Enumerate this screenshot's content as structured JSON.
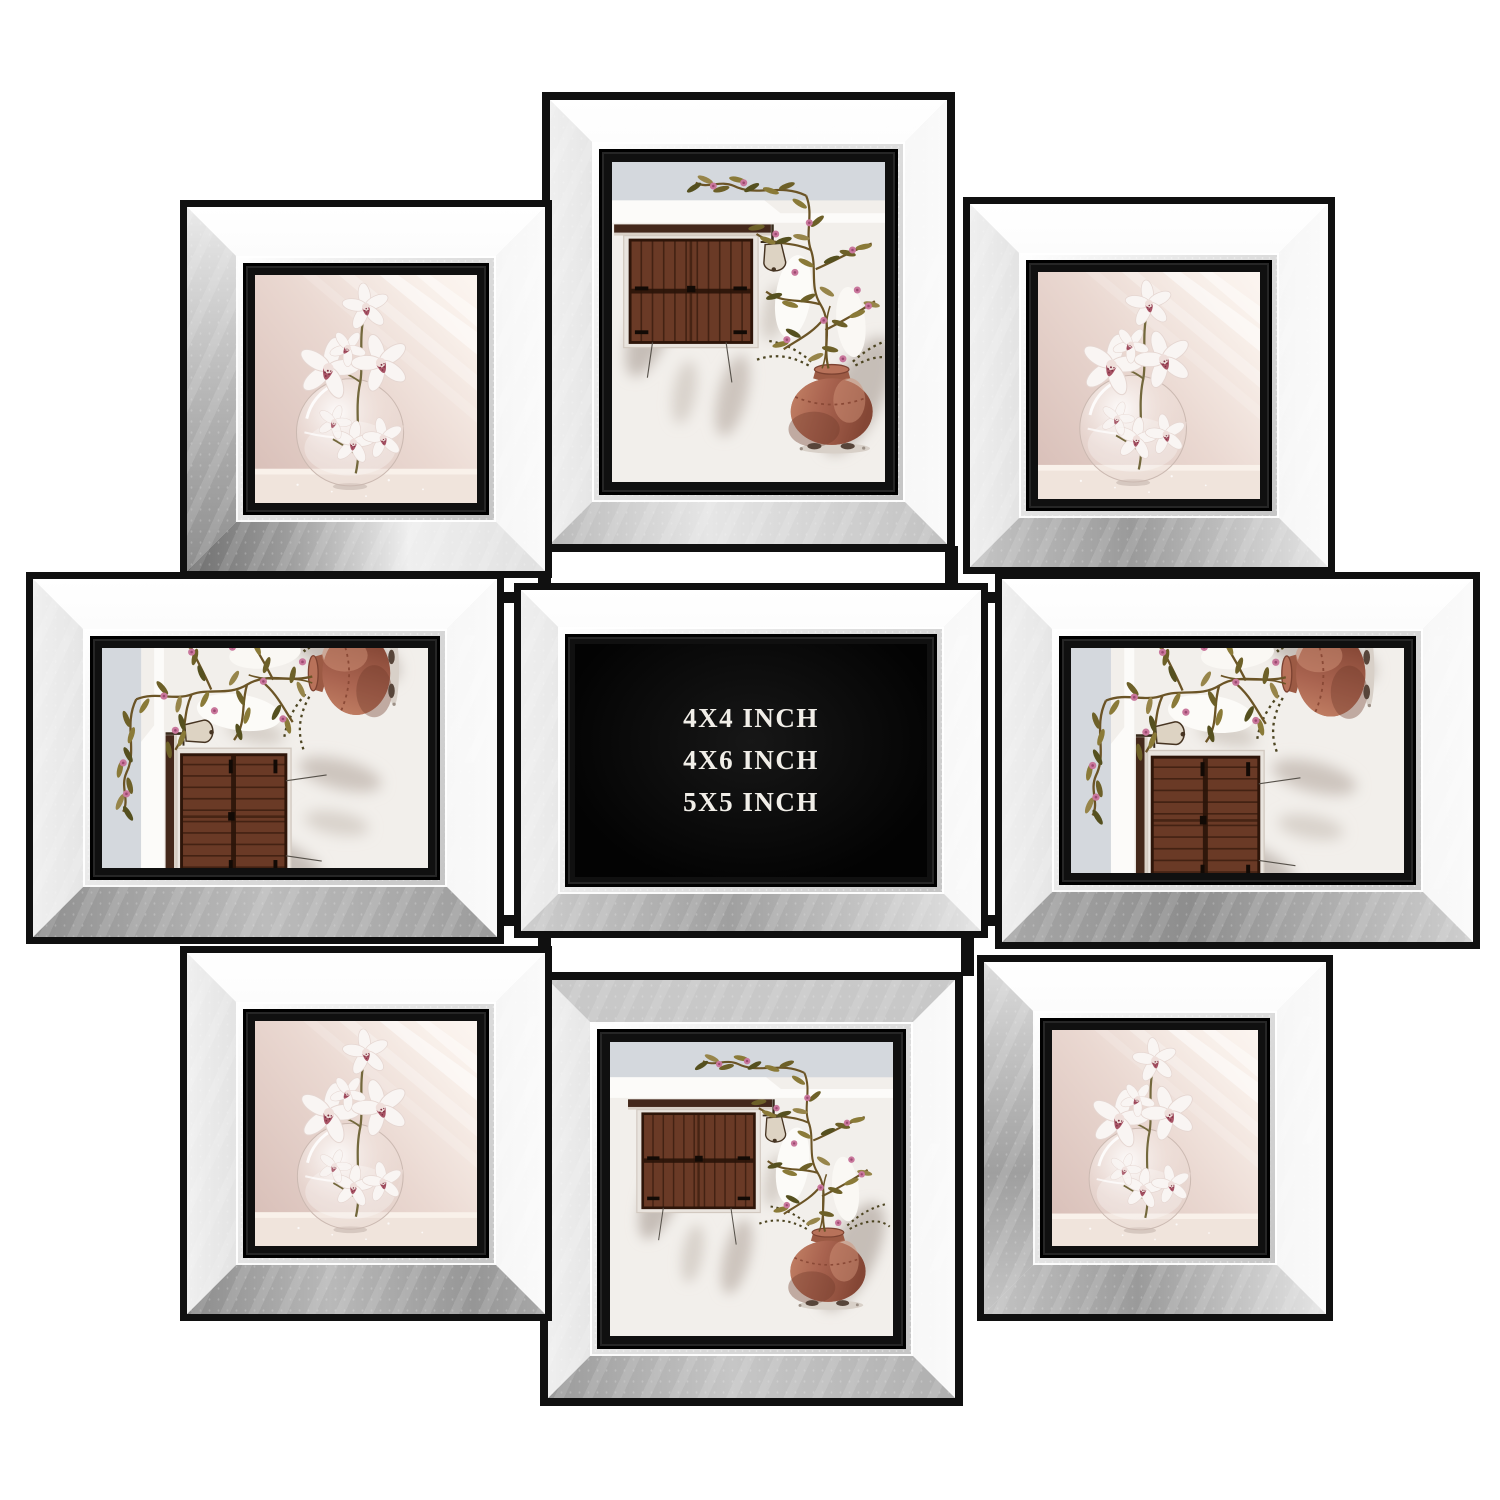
{
  "product": {
    "plaque": {
      "line1": "4X4 INCH",
      "line2": "4X6 INCH",
      "line3": "5X5 INCH"
    },
    "frames": [
      {
        "id": "top-left",
        "content": "orchid-photo"
      },
      {
        "id": "top-center",
        "content": "window-photo"
      },
      {
        "id": "top-right",
        "content": "orchid-photo"
      },
      {
        "id": "middle-left",
        "content": "window-photo-rotated"
      },
      {
        "id": "middle-center",
        "content": "size-plaque"
      },
      {
        "id": "middle-right",
        "content": "window-photo-rotated"
      },
      {
        "id": "bottom-left",
        "content": "orchid-photo"
      },
      {
        "id": "bottom-center",
        "content": "window-photo"
      },
      {
        "id": "bottom-right",
        "content": "orchid-photo"
      }
    ],
    "colors": {
      "background": "#ffffff",
      "frame_black": "#101010",
      "mirror_light": "#f5f5f5",
      "mirror_mid": "#c9c9c9",
      "mirror_dark": "#8d8d8d",
      "plaque_bg": "#060606",
      "plaque_text": "#f1eee8",
      "terracotta": "#a96450",
      "shutter_brown": "#6a3a26",
      "leaf_olive": "#7c6c30",
      "blossom_pink": "#c9779c",
      "photo_blush": "#e9d6cf"
    }
  }
}
